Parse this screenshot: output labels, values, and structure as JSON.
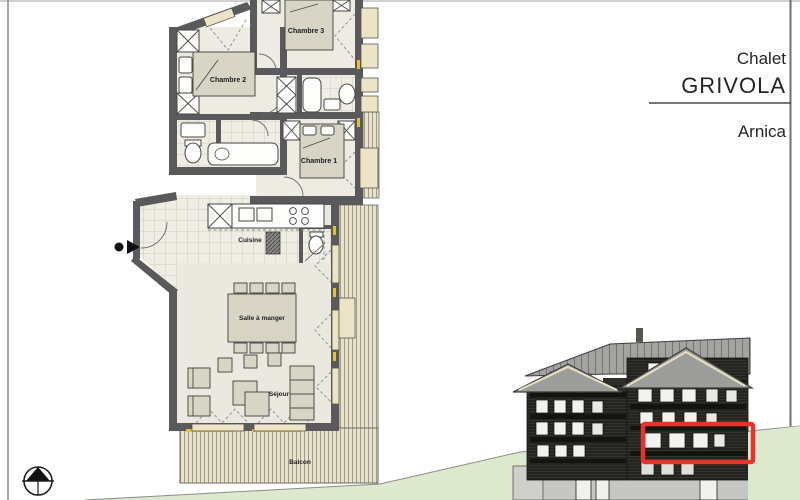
{
  "title_block": {
    "project": "Chalet",
    "project_name": "GRIVOLA",
    "unit_name": "Arnica"
  },
  "floor_plan": {
    "rooms": [
      {
        "label": "Chambre 2"
      },
      {
        "label": "Chambre 3"
      },
      {
        "label": "Chambre 1"
      },
      {
        "label": "Cuisine"
      },
      {
        "label": "Salle à manger"
      },
      {
        "label": "Séjour"
      },
      {
        "label": "Balcon"
      }
    ]
  },
  "icons": [
    {
      "name": "north-arrow"
    },
    {
      "name": "entrance-arrow"
    }
  ],
  "elevation": {
    "highlight_color": "#e8322c"
  },
  "colors": {
    "wall": "#5a5a5c",
    "floor": "#edebe2",
    "furniture": "#d9d5c6",
    "window": "#ece4c6",
    "planks": "#e8e2cc",
    "accent_yellow": "#e3c32e",
    "terrain_green": "#dde9cf",
    "roof_gray": "#a3a3a1",
    "facade_dark": "#23231f",
    "highlight_red": "#e8322c"
  }
}
